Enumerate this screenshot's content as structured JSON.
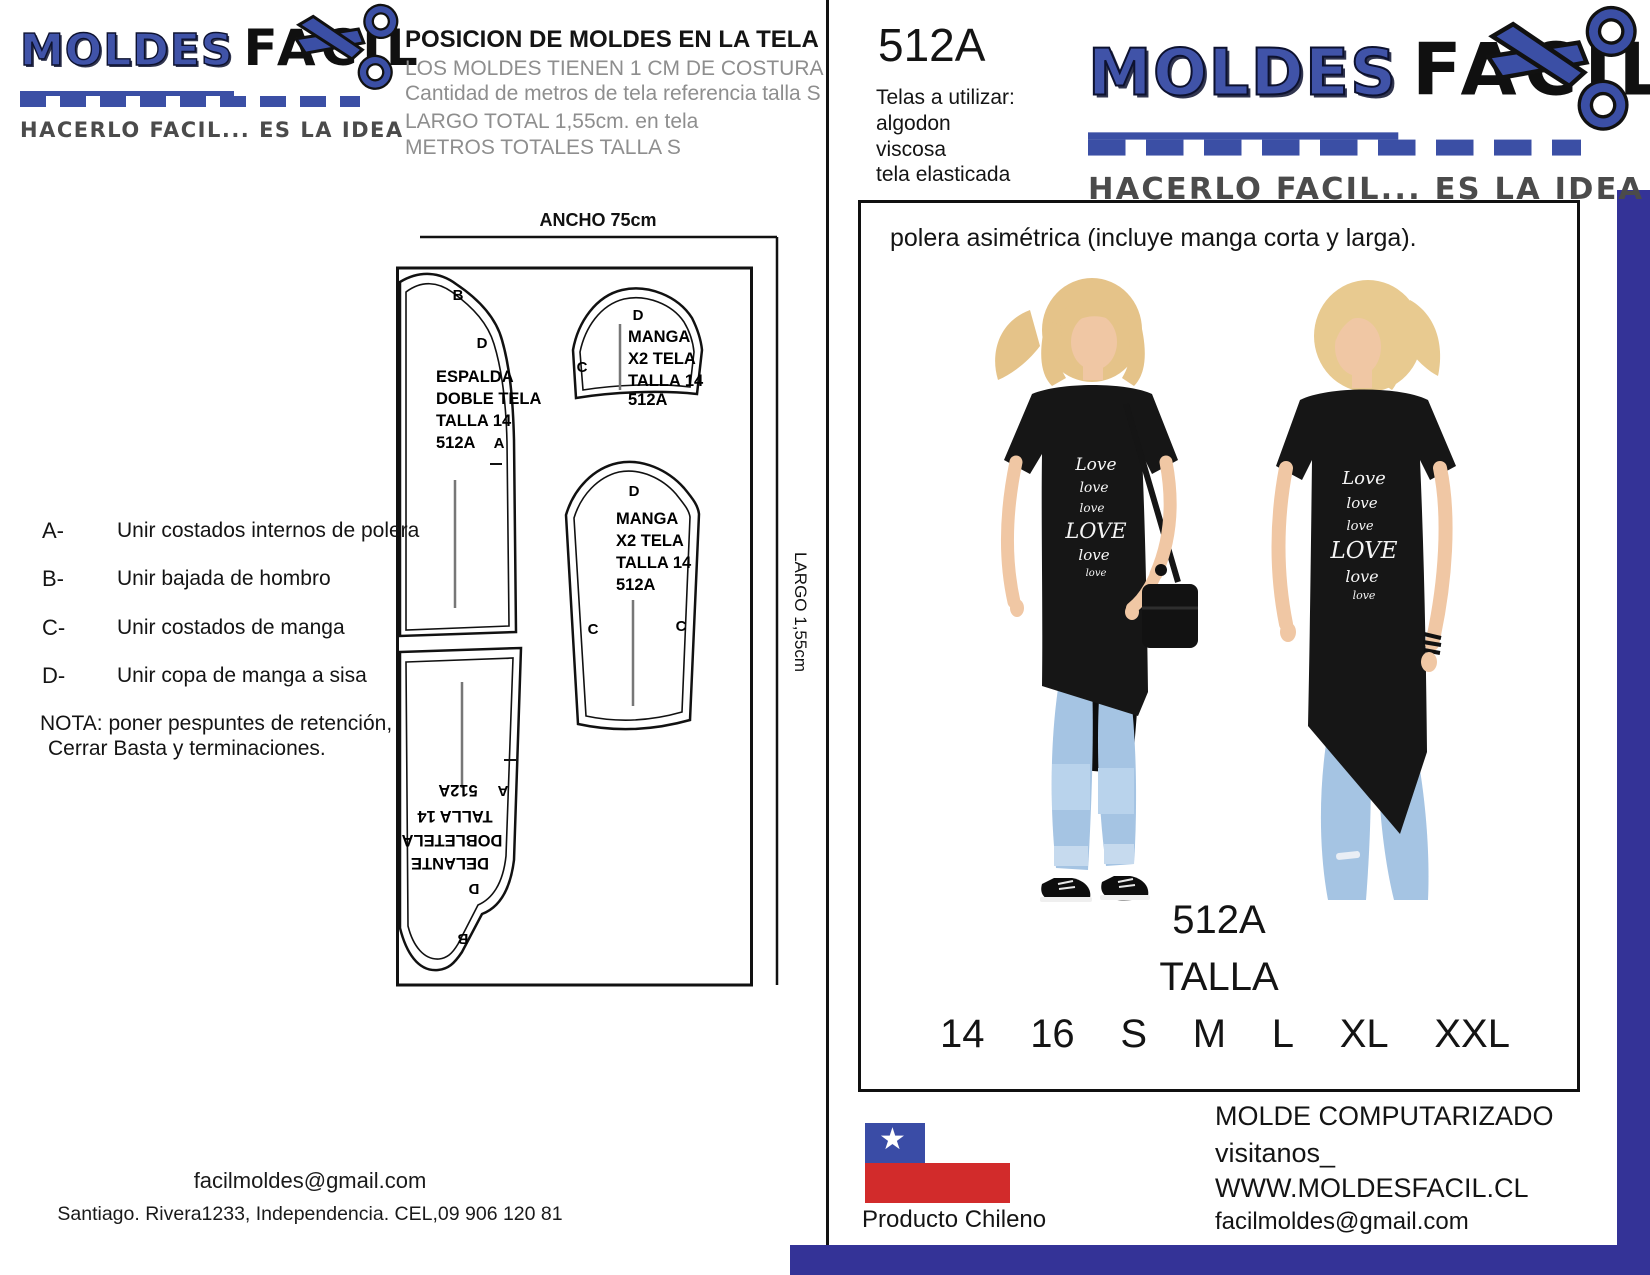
{
  "brand": {
    "name_bold": "MOLDES",
    "name_light": "FACIL",
    "tagline": "HACERLO FACIL... ES LA IDEA",
    "colors": {
      "logo_blue": "#3b4fa5",
      "navy_bar": "#343397",
      "flag_blue": "#3a4ca6",
      "flag_red": "#d22b2b",
      "subtitle_gray": "#8e8e8e"
    }
  },
  "left_page": {
    "header": {
      "title": "POSICION DE MOLDES EN LA TELA",
      "subtitle1": "LOS MOLDES TIENEN 1 CM DE COSTURA",
      "subtitle2": "Cantidad de metros de tela referencia talla S",
      "subtitle3": "LARGO TOTAL 1,55cm. en tela",
      "subtitle4": "METROS TOTALES TALLA S"
    },
    "diagram": {
      "width_label": "ANCHO 75cm",
      "length_label": "LARGO 1,55cm",
      "pieces": {
        "espalda": {
          "lines": [
            "ESPALDA",
            "DOBLE TELA",
            "TALLA 14",
            "512A"
          ],
          "marks": [
            "B",
            "D",
            "A"
          ]
        },
        "manga_corta": {
          "lines": [
            "MANGA",
            "X2 TELA",
            "TALLA 14",
            "512A"
          ],
          "marks": [
            "D",
            "C"
          ]
        },
        "manga_larga": {
          "lines": [
            "MANGA",
            "X2 TELA",
            "TALLA 14",
            "512A"
          ],
          "marks": [
            "D",
            "C",
            "C"
          ]
        },
        "delante": {
          "lines": [
            "DELANTE",
            "DOBLETELA",
            "TALLA 14",
            "512A"
          ],
          "marks": [
            "A",
            "D",
            "B"
          ]
        }
      }
    },
    "instructions": [
      {
        "key": "A-",
        "text": "Unir costados internos de polera"
      },
      {
        "key": "B-",
        "text": "Unir bajada de hombro"
      },
      {
        "key": "C-",
        "text": "Unir costados de manga"
      },
      {
        "key": "D-",
        "text": "Unir copa de manga a sisa"
      }
    ],
    "note1": "NOTA: poner pespuntes de retención,",
    "note2": "Cerrar Basta y terminaciones.",
    "contact": {
      "email": "facilmoldes@gmail.com",
      "address": "Santiago. Rivera1233, Independencia. CEL,09 906 120 81"
    }
  },
  "right_page": {
    "code": "512A",
    "fabrics": {
      "title": "Telas a utilizar:",
      "items": [
        "algodon",
        "viscosa",
        "tela elasticada"
      ]
    },
    "product": {
      "description": "polera asimétrica (incluye manga corta y larga).",
      "code": "512A",
      "size_title": "TALLA",
      "sizes": [
        "14",
        "16",
        "S",
        "M",
        "L",
        "XL",
        "XXL"
      ],
      "shirt_print": [
        "Love",
        "love",
        "love",
        "LOVE",
        "love",
        "love"
      ]
    },
    "footer": {
      "flag_caption": "Producto Chileno",
      "line1": "MOLDE COMPUTARIZADO",
      "line2": "visitanos_",
      "line3": "WWW.MOLDESFACIL.CL",
      "line4": "facilmoldes@gmail.com"
    }
  }
}
